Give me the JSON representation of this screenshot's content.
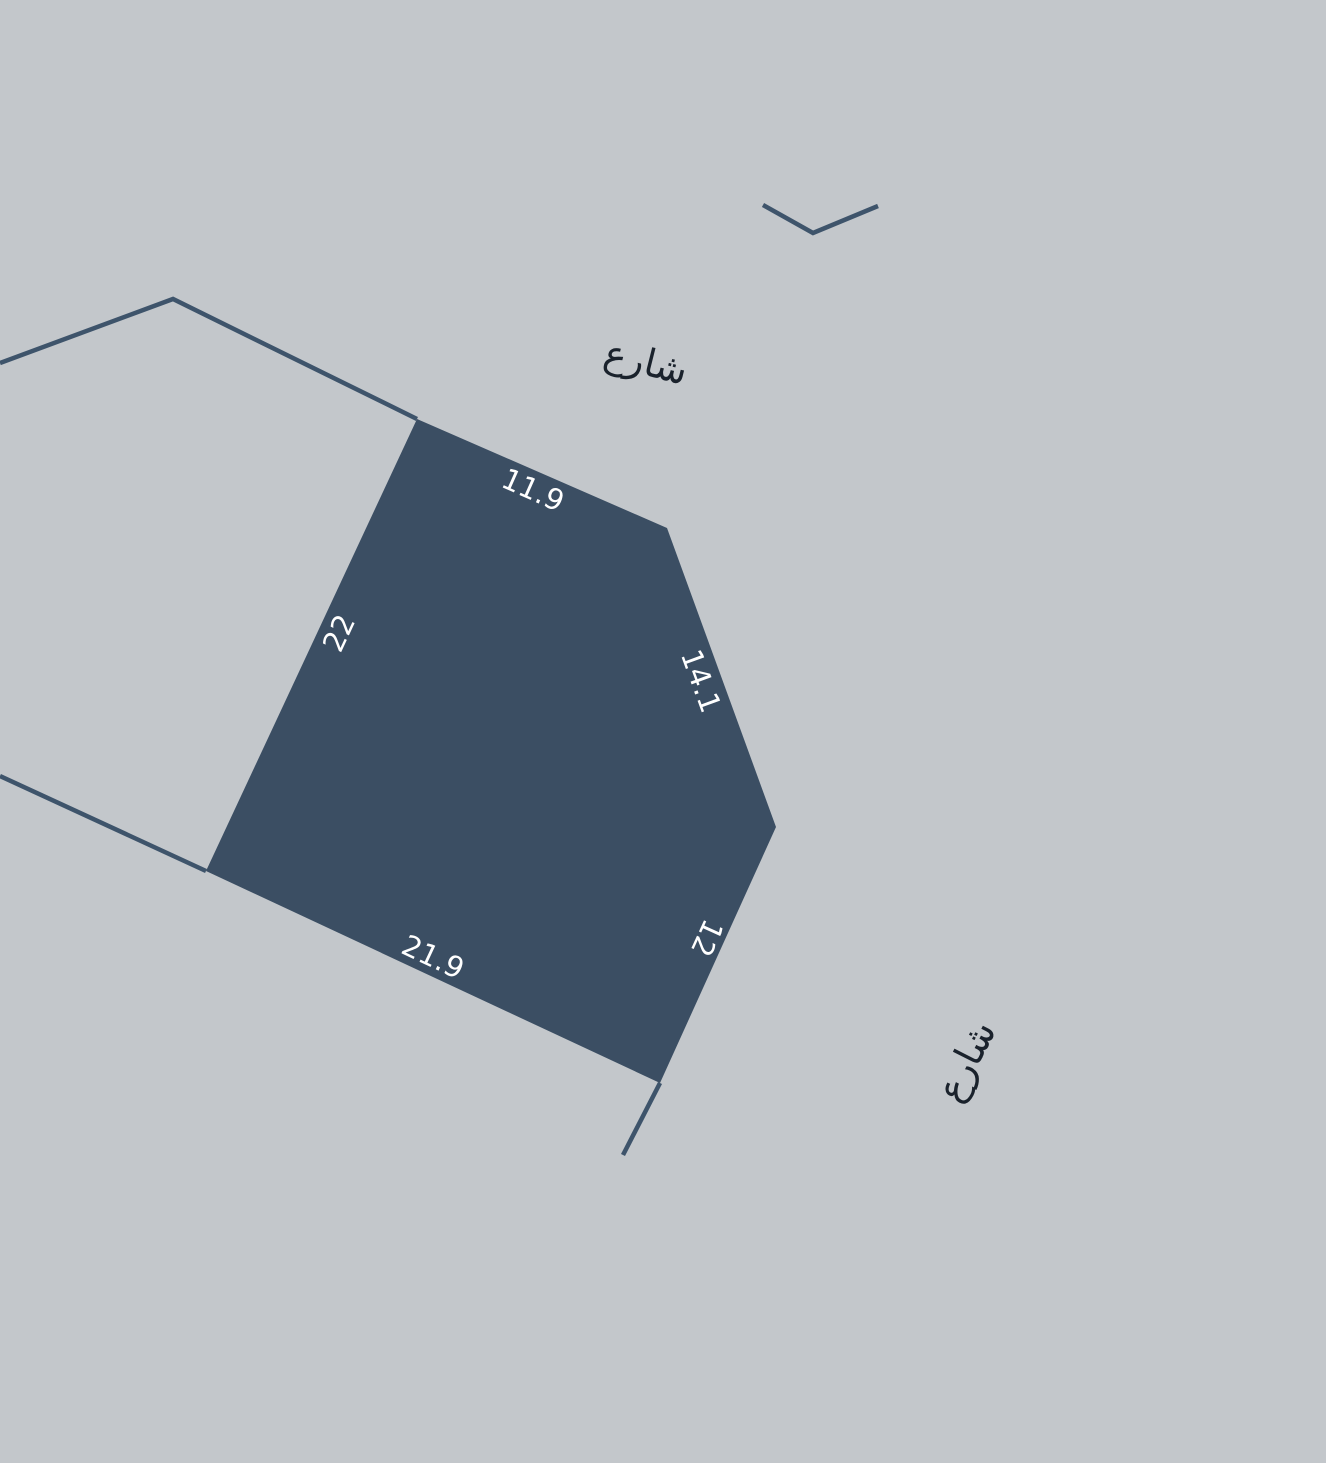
{
  "map": {
    "background_color": "#c3c7cb",
    "parcel": {
      "fill_color": "#3b4e63",
      "label_color": "#ffffff",
      "dimension_labels": {
        "top": "11.9",
        "upper_right": "14.1",
        "lower_right": "12",
        "bottom": "21.9",
        "left": "22"
      }
    },
    "boundaries": {
      "line_color": "#3e546b"
    },
    "streets": {
      "text_color": "#1a222c",
      "top_label": "شارع",
      "bottom_label": "شارع"
    }
  }
}
